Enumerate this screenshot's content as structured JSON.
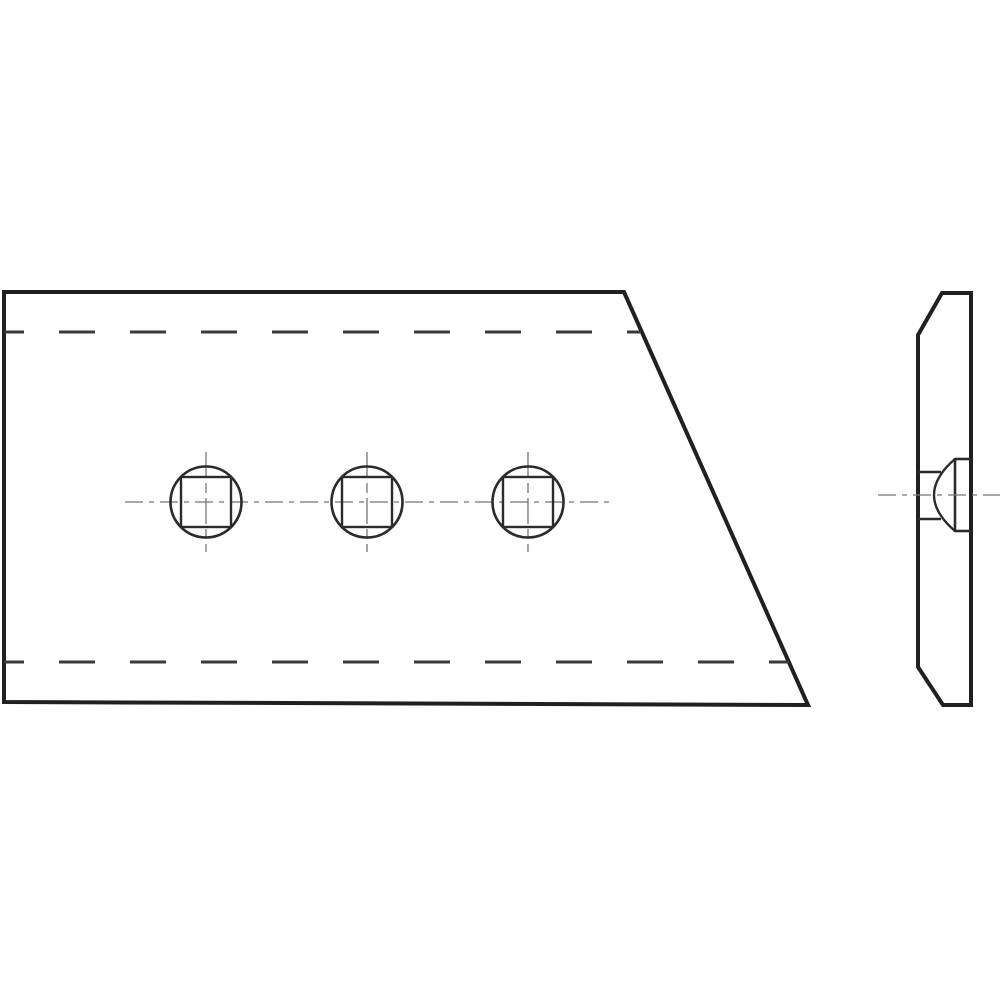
{
  "canvas": {
    "width": 1000,
    "height": 1000,
    "background": "#ffffff"
  },
  "colors": {
    "outline": "#231f20",
    "medium": "#2b2b2b",
    "hidden": "#3a3a3a",
    "centerline": "#757575"
  },
  "drawing": {
    "polygons": [
      {
        "name": "front-view-outline",
        "points": "4,292 624,292 808,705 4,702",
        "stroke": "outline",
        "width": 4
      },
      {
        "name": "side-view-outline",
        "points": "918,335 942,293 971,293 971,705 943,705 918,667",
        "stroke": "outline",
        "width": 4
      }
    ],
    "lines": [
      {
        "name": "hidden-line-top",
        "x1": 4,
        "y1": 332,
        "x2": 641,
        "y2": 332,
        "stroke": "hidden",
        "width": 3,
        "dash": "36 35",
        "offset": 16
      },
      {
        "name": "hidden-line-bottom",
        "x1": 4,
        "y1": 662,
        "x2": 789,
        "y2": 662,
        "stroke": "hidden",
        "width": 3,
        "dash": "36 35",
        "offset": 16
      },
      {
        "name": "holes-horizontal-centerline",
        "x1": 125,
        "y1": 502,
        "x2": 612,
        "y2": 502,
        "stroke": "centerline",
        "width": 1.3,
        "dash": "18 6 5 6",
        "offset": 0
      },
      {
        "name": "hole-1-vertical-centerline",
        "x1": 206,
        "y1": 452,
        "x2": 206,
        "y2": 552,
        "stroke": "centerline",
        "width": 1.3,
        "dash": "26 5 10 5",
        "offset": 0
      },
      {
        "name": "hole-2-vertical-centerline",
        "x1": 367,
        "y1": 452,
        "x2": 367,
        "y2": 552,
        "stroke": "centerline",
        "width": 1.3,
        "dash": "26 5 10 5",
        "offset": 0
      },
      {
        "name": "hole-3-vertical-centerline",
        "x1": 528,
        "y1": 452,
        "x2": 528,
        "y2": 552,
        "stroke": "centerline",
        "width": 1.3,
        "dash": "26 5 10 5",
        "offset": 0
      },
      {
        "name": "side-square-hole-edge-top",
        "x1": 918,
        "y1": 472,
        "x2": 941,
        "y2": 472,
        "stroke": "medium",
        "width": 2.4
      },
      {
        "name": "side-square-hole-edge-bottom",
        "x1": 918,
        "y1": 519,
        "x2": 941,
        "y2": 519,
        "stroke": "medium",
        "width": 2.4
      },
      {
        "name": "bolt-head-base-line",
        "x1": 955,
        "y1": 458,
        "x2": 955,
        "y2": 532,
        "stroke": "medium",
        "width": 2.6
      },
      {
        "name": "bolt-head-silhouette-top",
        "x1": 955,
        "y1": 459,
        "x2": 971,
        "y2": 459,
        "stroke": "medium",
        "width": 2.6
      },
      {
        "name": "bolt-head-silhouette-bottom",
        "x1": 955,
        "y1": 531,
        "x2": 971,
        "y2": 531,
        "stroke": "medium",
        "width": 2.6
      },
      {
        "name": "side-view-centerline",
        "x1": 878,
        "y1": 495,
        "x2": 1000,
        "y2": 495,
        "stroke": "centerline",
        "width": 1.3,
        "dash": "18 6 5 6",
        "offset": 0
      }
    ],
    "circles": [
      {
        "name": "bolt-hole-1-circle",
        "cx": 206,
        "cy": 502,
        "r": 35.5,
        "stroke": "medium",
        "width": 2.6
      },
      {
        "name": "bolt-hole-2-circle",
        "cx": 367,
        "cy": 502,
        "r": 35.5,
        "stroke": "medium",
        "width": 2.6
      },
      {
        "name": "bolt-hole-3-circle",
        "cx": 528,
        "cy": 502,
        "r": 35.5,
        "stroke": "medium",
        "width": 2.6
      }
    ],
    "rects": [
      {
        "name": "bolt-hole-1-square",
        "x": 181,
        "y": 477,
        "w": 50,
        "h": 50,
        "stroke": "medium",
        "width": 2.4
      },
      {
        "name": "bolt-hole-2-square",
        "x": 342,
        "y": 477,
        "w": 50,
        "h": 50,
        "stroke": "medium",
        "width": 2.4
      },
      {
        "name": "bolt-hole-3-square",
        "x": 503,
        "y": 477,
        "w": 50,
        "h": 50,
        "stroke": "medium",
        "width": 2.4
      }
    ],
    "paths": [
      {
        "name": "bolt-head-dome-arc",
        "d": "M 955 459 Q 913 495 955 531",
        "stroke": "medium",
        "width": 2.4
      }
    ]
  }
}
